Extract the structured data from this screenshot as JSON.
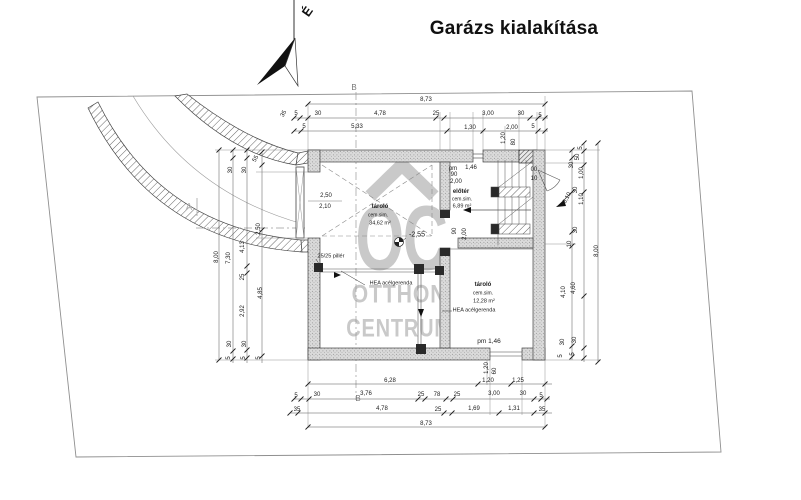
{
  "title": "Garázs kialakítása",
  "north": {
    "label": "É"
  },
  "watermark": {
    "monogram": "OC",
    "line1": "OTTHON",
    "line2": "CENTRUM"
  },
  "rooms": [
    {
      "name": "tároló",
      "finish": "cem.sim.",
      "area": "34,62 m²",
      "floor_level": "-2,55"
    },
    {
      "name": "előtér",
      "finish": "cem.sim.",
      "area": "6,89 m²"
    },
    {
      "name": "tároló",
      "finish": "cem.sim.",
      "area": "12,28 m²"
    }
  ],
  "overall_dimensions": {
    "total_width": "8,73",
    "total_height": "8,00"
  },
  "labels": {
    "top_chain": [
      {
        "t": "8,73",
        "x": 426,
        "y": 100
      },
      {
        "t": "5",
        "x": 296,
        "y": 114
      },
      {
        "t": "30",
        "x": 318,
        "y": 114
      },
      {
        "t": "4,78",
        "x": 380,
        "y": 114
      },
      {
        "t": "25",
        "x": 436,
        "y": 114
      },
      {
        "t": "3,00",
        "x": 488,
        "y": 114
      },
      {
        "t": "30",
        "x": 521,
        "y": 114
      },
      {
        "t": "5",
        "x": 540,
        "y": 116
      },
      {
        "t": "5",
        "x": 304,
        "y": 127
      },
      {
        "t": "5,33",
        "x": 357,
        "y": 127
      },
      {
        "t": "1,30",
        "x": 470,
        "y": 128
      },
      {
        "t": "2,00",
        "x": 512,
        "y": 128
      },
      {
        "t": "5",
        "x": 533,
        "y": 127
      },
      {
        "t": "1,20",
        "x": 504,
        "y": 138,
        "r": -90
      },
      {
        "t": "80",
        "x": 514,
        "y": 142,
        "r": -90
      }
    ],
    "bottom_chain": [
      {
        "t": "6,28",
        "x": 390,
        "y": 381
      },
      {
        "t": "1,20",
        "x": 488,
        "y": 381
      },
      {
        "t": "1,25",
        "x": 518,
        "y": 381
      },
      {
        "t": "5",
        "x": 296,
        "y": 396
      },
      {
        "t": "30",
        "x": 317,
        "y": 395
      },
      {
        "t": "3,76",
        "x": 366,
        "y": 394
      },
      {
        "t": "25",
        "x": 421,
        "y": 395
      },
      {
        "t": "78",
        "x": 437,
        "y": 395
      },
      {
        "t": "25",
        "x": 457,
        "y": 395
      },
      {
        "t": "3,00",
        "x": 494,
        "y": 394
      },
      {
        "t": "30",
        "x": 523,
        "y": 394
      },
      {
        "t": "5",
        "x": 541,
        "y": 396
      },
      {
        "t": "35",
        "x": 297,
        "y": 410
      },
      {
        "t": "4,78",
        "x": 382,
        "y": 409
      },
      {
        "t": "25",
        "x": 438,
        "y": 410
      },
      {
        "t": "1,69",
        "x": 474,
        "y": 409
      },
      {
        "t": "1,31",
        "x": 514,
        "y": 409
      },
      {
        "t": "35",
        "x": 542,
        "y": 410
      },
      {
        "t": "8,73",
        "x": 426,
        "y": 424
      },
      {
        "t": "1,20",
        "x": 487,
        "y": 368,
        "r": -90
      },
      {
        "t": "60",
        "x": 495,
        "y": 371,
        "r": -90
      },
      {
        "t": "pm 1,46",
        "x": 489,
        "y": 342,
        "s": 6.5
      }
    ],
    "left_chain": [
      {
        "t": "8,00",
        "x": 217,
        "y": 257,
        "r": -90
      },
      {
        "t": "30",
        "x": 231,
        "y": 170,
        "r": -90
      },
      {
        "t": "7,30",
        "x": 229,
        "y": 258,
        "r": -90
      },
      {
        "t": "30",
        "x": 230,
        "y": 344,
        "r": -90
      },
      {
        "t": "5",
        "x": 229,
        "y": 358,
        "r": -90
      },
      {
        "t": "30",
        "x": 245,
        "y": 170,
        "r": -90
      },
      {
        "t": "4,13",
        "x": 243,
        "y": 247,
        "r": -90
      },
      {
        "t": "25",
        "x": 243,
        "y": 277,
        "r": -90
      },
      {
        "t": "2,92",
        "x": 243,
        "y": 311,
        "r": -90
      },
      {
        "t": "30",
        "x": 245,
        "y": 344,
        "r": -90
      },
      {
        "t": "5",
        "x": 244,
        "y": 358,
        "r": -90
      },
      {
        "t": "55",
        "x": 256,
        "y": 159,
        "r": -60
      },
      {
        "t": "2,50",
        "x": 259,
        "y": 229,
        "r": -90
      },
      {
        "t": "4,85",
        "x": 261,
        "y": 293,
        "r": -90
      },
      {
        "t": "5",
        "x": 259,
        "y": 358,
        "r": -90
      },
      {
        "t": "35",
        "x": 284,
        "y": 114,
        "r": -60
      }
    ],
    "right_chain": [
      {
        "t": "8,00",
        "x": 597,
        "y": 251,
        "r": -90
      },
      {
        "t": "30",
        "x": 572,
        "y": 165,
        "r": -90
      },
      {
        "t": "30",
        "x": 576,
        "y": 190,
        "r": -90
      },
      {
        "t": "30",
        "x": 576,
        "y": 230,
        "r": -90
      },
      {
        "t": "10",
        "x": 570,
        "y": 244,
        "r": -90
      },
      {
        "t": "4,10",
        "x": 564,
        "y": 292,
        "r": -90
      },
      {
        "t": "30",
        "x": 563,
        "y": 342,
        "r": -90
      },
      {
        "t": "5",
        "x": 561,
        "y": 356,
        "r": -90
      },
      {
        "t": "5",
        "x": 581,
        "y": 148,
        "r": -90
      },
      {
        "t": "50",
        "x": 578,
        "y": 157,
        "r": -90
      },
      {
        "t": "1,00",
        "x": 582,
        "y": 173,
        "r": -90
      },
      {
        "t": "1,10",
        "x": 582,
        "y": 199,
        "r": -90
      },
      {
        "t": "4,60",
        "x": 574,
        "y": 288,
        "r": -90
      },
      {
        "t": "30",
        "x": 575,
        "y": 340,
        "r": -90
      },
      {
        "t": "5",
        "x": 573,
        "y": 354,
        "r": -90
      },
      {
        "t": "-3,10",
        "x": 567,
        "y": 199,
        "r": -62
      }
    ],
    "interior": [
      {
        "t": "2,50",
        "x": 326,
        "y": 196
      },
      {
        "t": "2,10",
        "x": 325,
        "y": 207
      },
      {
        "t": "tároló",
        "x": 380,
        "y": 207,
        "b": 1
      },
      {
        "t": "cem.sim.",
        "x": 378,
        "y": 216,
        "s": 5
      },
      {
        "t": "34,62 m²",
        "x": 380,
        "y": 224,
        "s": 5.5
      },
      {
        "t": "-2,55",
        "x": 417,
        "y": 235,
        "s": 7
      },
      {
        "t": "25/25 pillér",
        "x": 331,
        "y": 257,
        "s": 5.5
      },
      {
        "t": "HEA acélgerenda",
        "x": 391,
        "y": 284,
        "s": 5.5
      },
      {
        "t": "HEA acélgerenda",
        "x": 474,
        "y": 311,
        "s": 5.5
      },
      {
        "t": "tároló",
        "x": 483,
        "y": 285,
        "b": 1
      },
      {
        "t": "cem.sim.",
        "x": 483,
        "y": 294,
        "s": 5
      },
      {
        "t": "12,28 m²",
        "x": 484,
        "y": 302,
        "s": 5.5
      },
      {
        "t": "pm",
        "x": 453,
        "y": 169
      },
      {
        "t": "90",
        "x": 454,
        "y": 175
      },
      {
        "t": "1,46",
        "x": 471,
        "y": 168
      },
      {
        "t": "2,00",
        "x": 456,
        "y": 182
      },
      {
        "t": "előtér",
        "x": 461,
        "y": 192,
        "b": 1
      },
      {
        "t": "cem.sim.",
        "x": 462,
        "y": 200,
        "s": 5
      },
      {
        "t": "6,89 m²",
        "x": 462,
        "y": 207,
        "s": 5.5
      },
      {
        "t": "90",
        "x": 455,
        "y": 231,
        "r": -90
      },
      {
        "t": "2,00",
        "x": 465,
        "y": 234,
        "r": -90
      },
      {
        "t": "00",
        "x": 534,
        "y": 170
      },
      {
        "t": "10",
        "x": 534,
        "y": 179
      }
    ],
    "markers": [
      {
        "t": "B",
        "x": 354,
        "y": 88,
        "c": "#777",
        "s": 8
      },
      {
        "t": "B",
        "x": 358,
        "y": 399,
        "c": "#777",
        "s": 8
      },
      {
        "t": "A",
        "x": 189,
        "y": 208,
        "c": "#b5b5b5",
        "s": 10
      }
    ]
  }
}
